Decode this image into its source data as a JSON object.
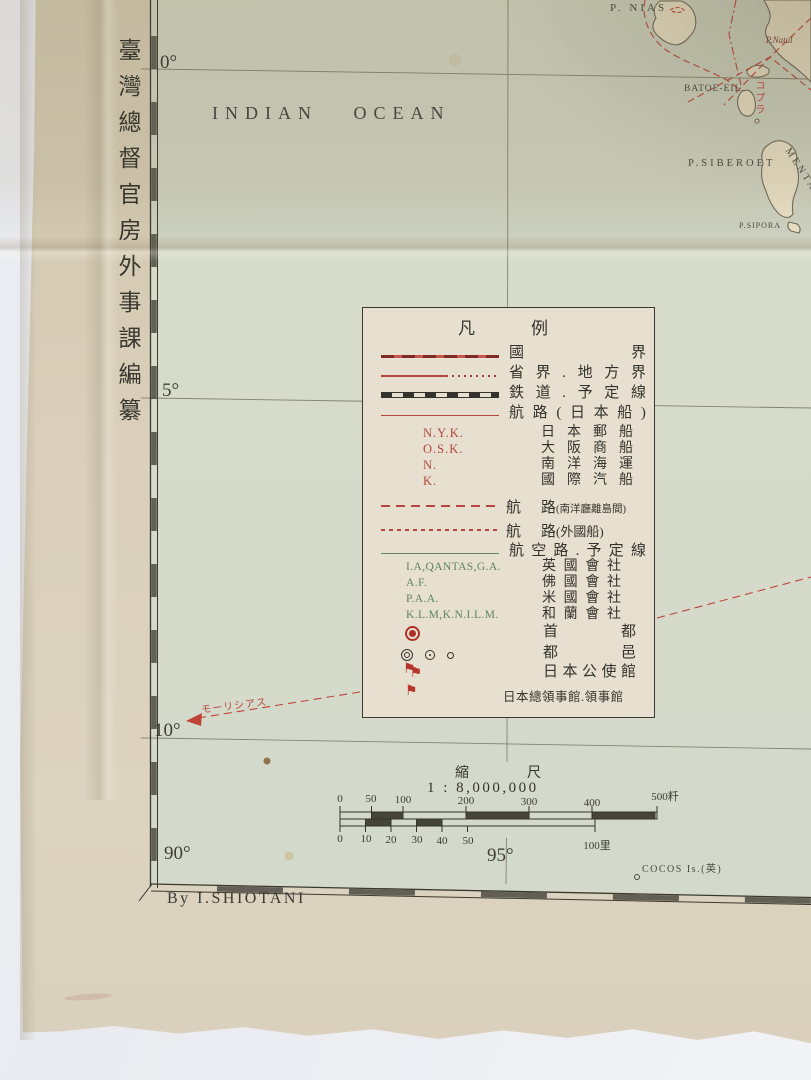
{
  "attribution": {
    "publisher_vertical": "臺灣總督官房外事課編纂",
    "byline": "By I.SHIOTANI"
  },
  "map": {
    "ocean_label": "INDIAN OCEAN",
    "graticule": {
      "lat": [
        "0°",
        "5°",
        "10°"
      ],
      "lon": [
        "90°",
        "95°"
      ]
    },
    "places": {
      "nias": "P. NIAS",
      "natal": "P.Natal",
      "batoe": "BATOE-EIL.",
      "siberoet": "P.SIBEROET",
      "mentawei": "MENTAWEI-",
      "sipora": "P.SIPORA",
      "cocos": "COCOS Is.(英)"
    },
    "annotations": {
      "mauritius": "モーリシアス",
      "copra": "コプラ"
    }
  },
  "legend": {
    "title": "凡例",
    "flag_glyph": "⚑",
    "rows": [
      {
        "label": "國界"
      },
      {
        "label": "省界.地方界"
      },
      {
        "label": "鉄道.予定線"
      },
      {
        "label": "航路(日本船)"
      }
    ],
    "jp_lines": [
      {
        "code": "N.Y.K.",
        "name": "日本郵船"
      },
      {
        "code": "O.S.K.",
        "name": "大阪商船"
      },
      {
        "code": "N.",
        "name": "南洋海運"
      },
      {
        "code": "K.",
        "name": "國際汽船"
      }
    ],
    "routes": [
      {
        "main": "航路",
        "paren": "(南洋廳離島間)"
      },
      {
        "main": "航路",
        "paren": "(外國船)"
      }
    ],
    "air_row": {
      "label": "航空路.予定線"
    },
    "airlines": [
      {
        "code": "I.A,QANTAS,G.A.",
        "name": "英國會社"
      },
      {
        "code": "A.F.",
        "name": "佛國會社"
      },
      {
        "code": "P.A.A.",
        "name": "米國會社"
      },
      {
        "code": "K.L.M,K.N.I.L.M.",
        "name": "和蘭會社"
      }
    ],
    "symbols": [
      {
        "label": "首都"
      },
      {
        "label": "都邑"
      },
      {
        "label": "日本公使館"
      },
      {
        "label": "日本總領事館.領事館"
      }
    ]
  },
  "scale": {
    "title": "縮尺",
    "ratio": "1 : 8,000,000",
    "km_ticks": [
      "0",
      "50",
      "100",
      "200",
      "300",
      "400",
      "500粁"
    ],
    "ri_ticks": [
      "0",
      "10",
      "20",
      "30",
      "40",
      "50",
      "100里"
    ]
  }
}
